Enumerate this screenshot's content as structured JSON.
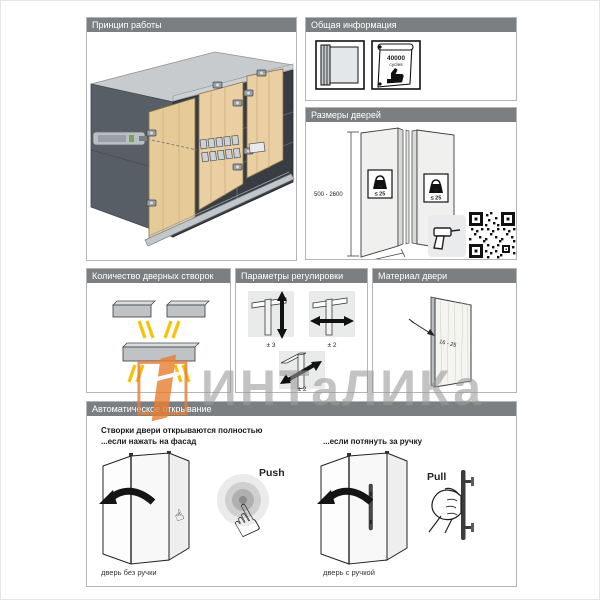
{
  "watermark": {
    "text": "ИНТаЛИКа"
  },
  "panels": {
    "principle": {
      "title": "Принцип работы"
    },
    "general_info": {
      "title": "Общая информация",
      "cycles_value": "40000",
      "cycles_unit": "cycles"
    },
    "door_sizes": {
      "title": "Размеры дверей",
      "height_range": "500 - 2600",
      "width_range": "250 - 600",
      "weight_limit": "≤ 25",
      "weight_unit": "kg",
      "link": "hettich.com/short/B68172"
    },
    "leaf_count": {
      "title": "Количество дверных створок"
    },
    "adjustment": {
      "title": "Параметры регулировки",
      "vertical": "± 3",
      "horizontal": "± 2",
      "diagonal": "± 2"
    },
    "door_material": {
      "title": "Материал двери",
      "thickness": "16 - 25"
    },
    "auto_opening": {
      "title": "Автоматическое открывание",
      "heading": "Створки двери открываются полностью",
      "sub_push": "...если нажать на фасад",
      "sub_pull": "...если потянуть за ручку",
      "push_label": "Push",
      "pull_label": "Pull",
      "caption_no_handle": "дверь без ручки",
      "caption_handle": "дверь с ручкой"
    }
  },
  "colors": {
    "accent_orange": "#e87f35",
    "leg_yellow": "#f7c918",
    "wood": "#e9cfa2",
    "header_gray": "#7c7f81"
  }
}
